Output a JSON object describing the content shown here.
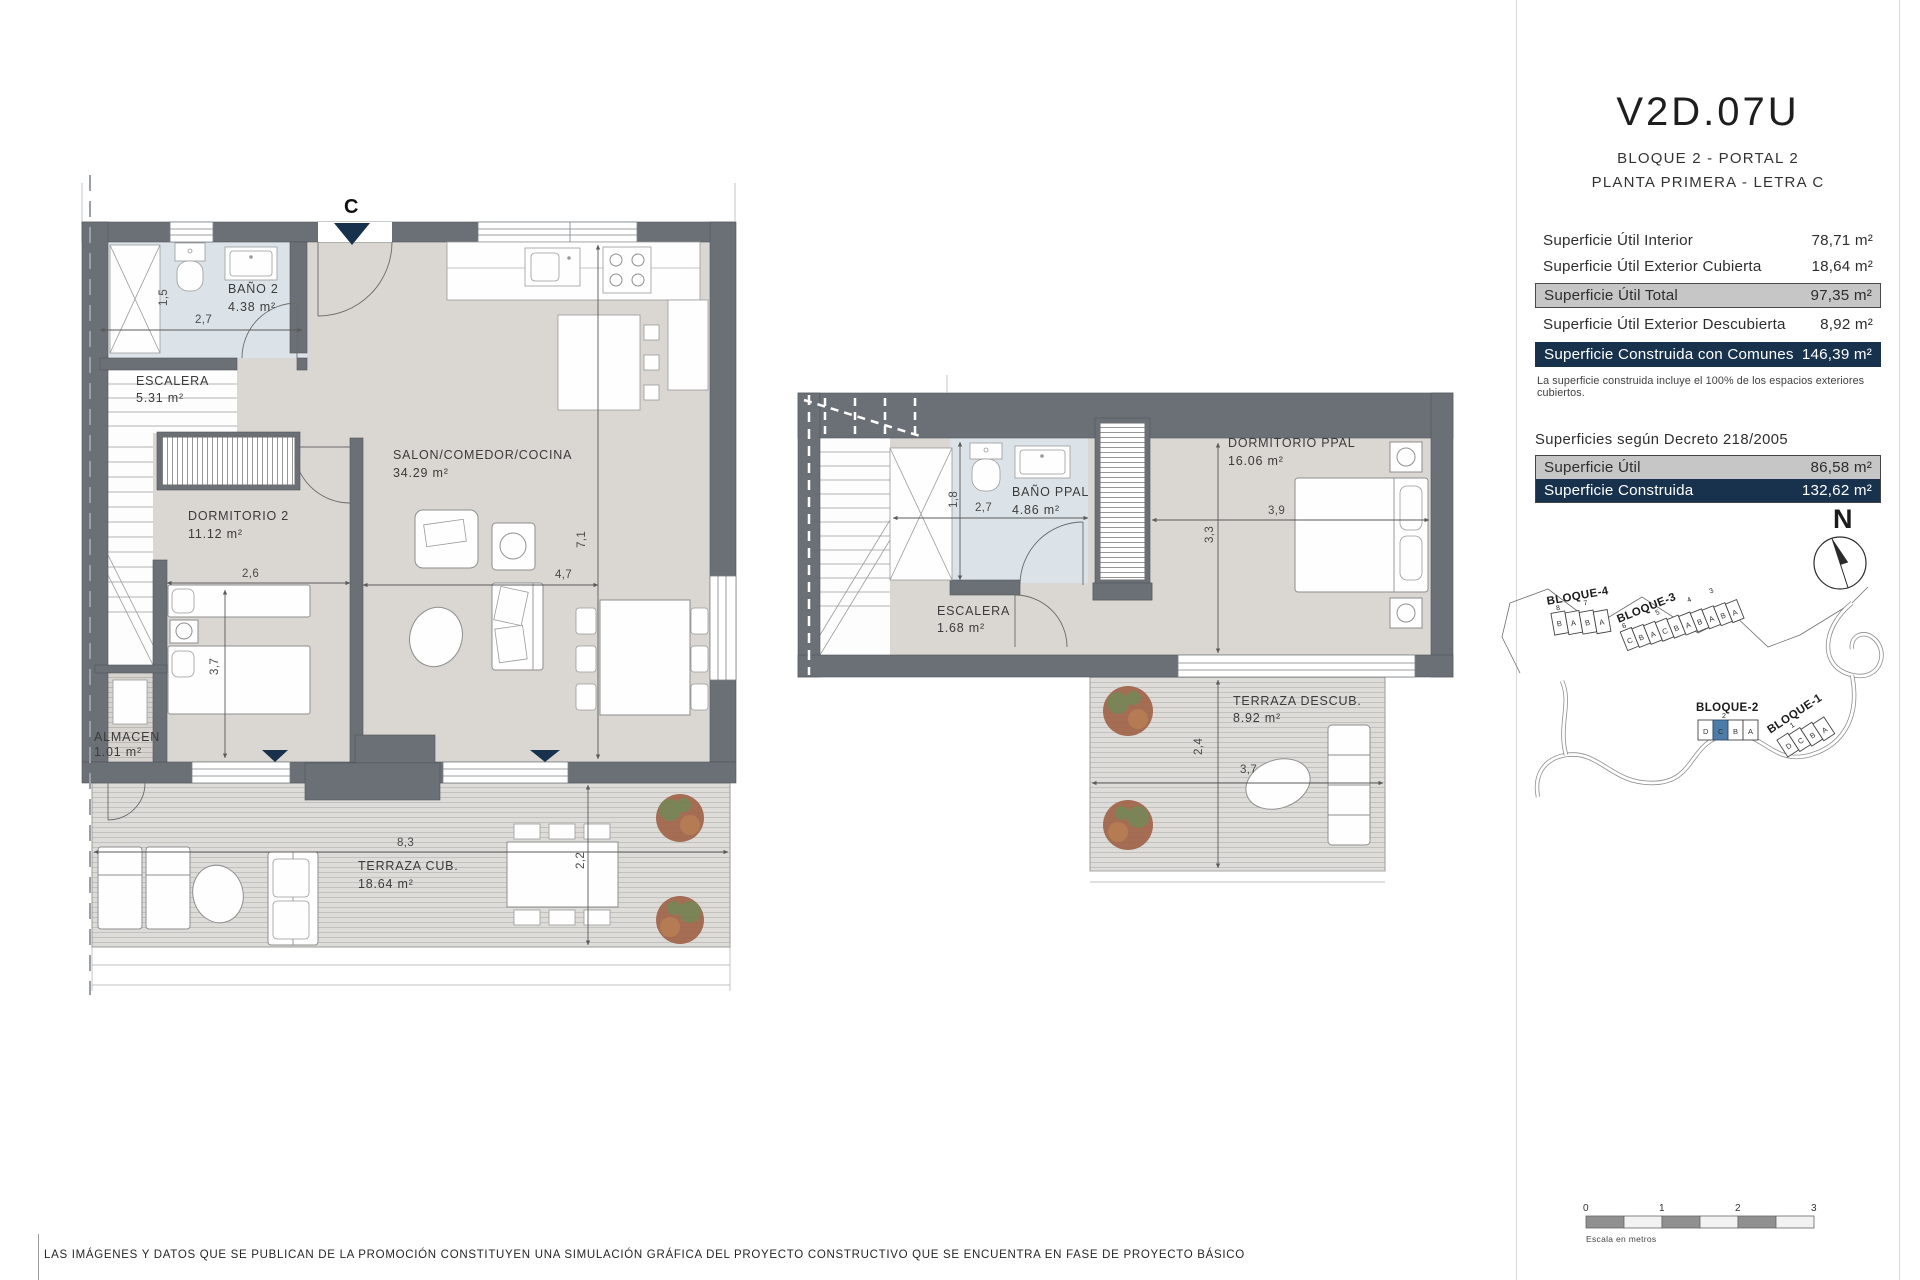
{
  "header": {
    "code": "V2D.07U",
    "subtitle1": "BLOQUE 2 - PORTAL 2",
    "subtitle2": "PLANTA PRIMERA - LETRA C"
  },
  "areas": {
    "rows": [
      {
        "label": "Superficie Útil Interior",
        "value": "78,71 m²",
        "highlight": "none"
      },
      {
        "label": "Superficie Útil Exterior Cubierta",
        "value": "18,64 m²",
        "highlight": "none"
      },
      {
        "label": "Superficie Útil Total",
        "value": "97,35 m²",
        "highlight": "gray"
      },
      {
        "label": "Superficie Útil Exterior Descubierta",
        "value": "8,92 m²",
        "highlight": "none"
      },
      {
        "label": "Superficie Construida con Comunes",
        "value": "146,39 m²",
        "highlight": "navy"
      }
    ],
    "note": "La superficie construida incluye el 100% de los espacios exteriores cubiertos."
  },
  "decreto": {
    "heading": "Superficies según Decreto 218/2005",
    "rows": [
      {
        "label": "Superficie Útil",
        "value": "86,58 m²",
        "highlight": "gray"
      },
      {
        "label": "Superficie Construida",
        "value": "132,62 m²",
        "highlight": "navy"
      }
    ]
  },
  "compass": {
    "label": "N"
  },
  "plan1": {
    "entrance_letter": "C",
    "rooms": {
      "bano2": {
        "name": "BAÑO 2",
        "area": "4.38 m²"
      },
      "escalera": {
        "name": "ESCALERA",
        "area": "5.31 m²"
      },
      "dormitorio2": {
        "name": "DORMITORIO 2",
        "area": "11.12 m²"
      },
      "salon": {
        "name": "SALON/COMEDOR/COCINA",
        "area": "34.29 m²"
      },
      "almacen": {
        "name": "ALMACEN",
        "area": "1.01 m²"
      },
      "terraza": {
        "name": "TERRAZA CUB.",
        "area": "18.64 m²"
      }
    },
    "dims": {
      "bano_h": "1,5",
      "bano_w": "2,7",
      "dorm_w": "2,6",
      "dorm_h": "3,7",
      "salon_h": "7,1",
      "salon_w": "4,7",
      "terraza_w": "8,3",
      "terraza_h": "2,2"
    }
  },
  "plan2": {
    "rooms": {
      "bano": {
        "name": "BAÑO PPAL",
        "area": "4.86 m²"
      },
      "escalera": {
        "name": "ESCALERA",
        "area": "1.68 m²"
      },
      "dormitorio": {
        "name": "DORMITORIO PPAL",
        "area": "16.06 m²"
      },
      "terraza": {
        "name": "TERRAZA DESCUB.",
        "area": "8.92 m²"
      }
    },
    "dims": {
      "bano_h": "1,8",
      "bano_w": "2,7",
      "dorm_w": "3,9",
      "dorm_h": "3,3",
      "terraza_h": "2,4",
      "terraza_w": "3,7"
    }
  },
  "site_plan": {
    "blocks": [
      {
        "name": "BLOQUE-4",
        "units": [
          "B",
          "A",
          "B",
          "A"
        ],
        "portals": [
          "8",
          "7"
        ]
      },
      {
        "name": "BLOQUE-3",
        "units": [
          "C",
          "B",
          "A",
          "C",
          "B",
          "A",
          "B",
          "A",
          "B",
          "A"
        ],
        "portals": [
          "6",
          "5",
          "4",
          "3"
        ]
      },
      {
        "name": "BLOQUE-2",
        "units": [
          "D",
          "C",
          "B",
          "A"
        ],
        "portals": [
          "2"
        ],
        "highlighted_unit": "C"
      },
      {
        "name": "BLOQUE-1",
        "units": [
          "D",
          "C",
          "B",
          "A"
        ],
        "portals": [
          "1"
        ]
      }
    ]
  },
  "scale_bar": {
    "ticks": [
      "0",
      "1",
      "2",
      "3"
    ],
    "caption": "Escala en metros"
  },
  "footer": {
    "disclaimer": "LAS IMÁGENES Y DATOS QUE SE PUBLICAN DE LA PROMOCIÓN CONSTITUYEN UNA SIMULACIÓN GRÁFICA DEL PROYECTO CONSTRUCTIVO QUE SE ENCUENTRA EN FASE DE PROYECTO BÁSICO"
  },
  "colors": {
    "navy": "#18324e",
    "highlight_gray": "#c6c6c6",
    "unit_blue": "#4e7ca8",
    "wall_gray": "#6b7076"
  }
}
